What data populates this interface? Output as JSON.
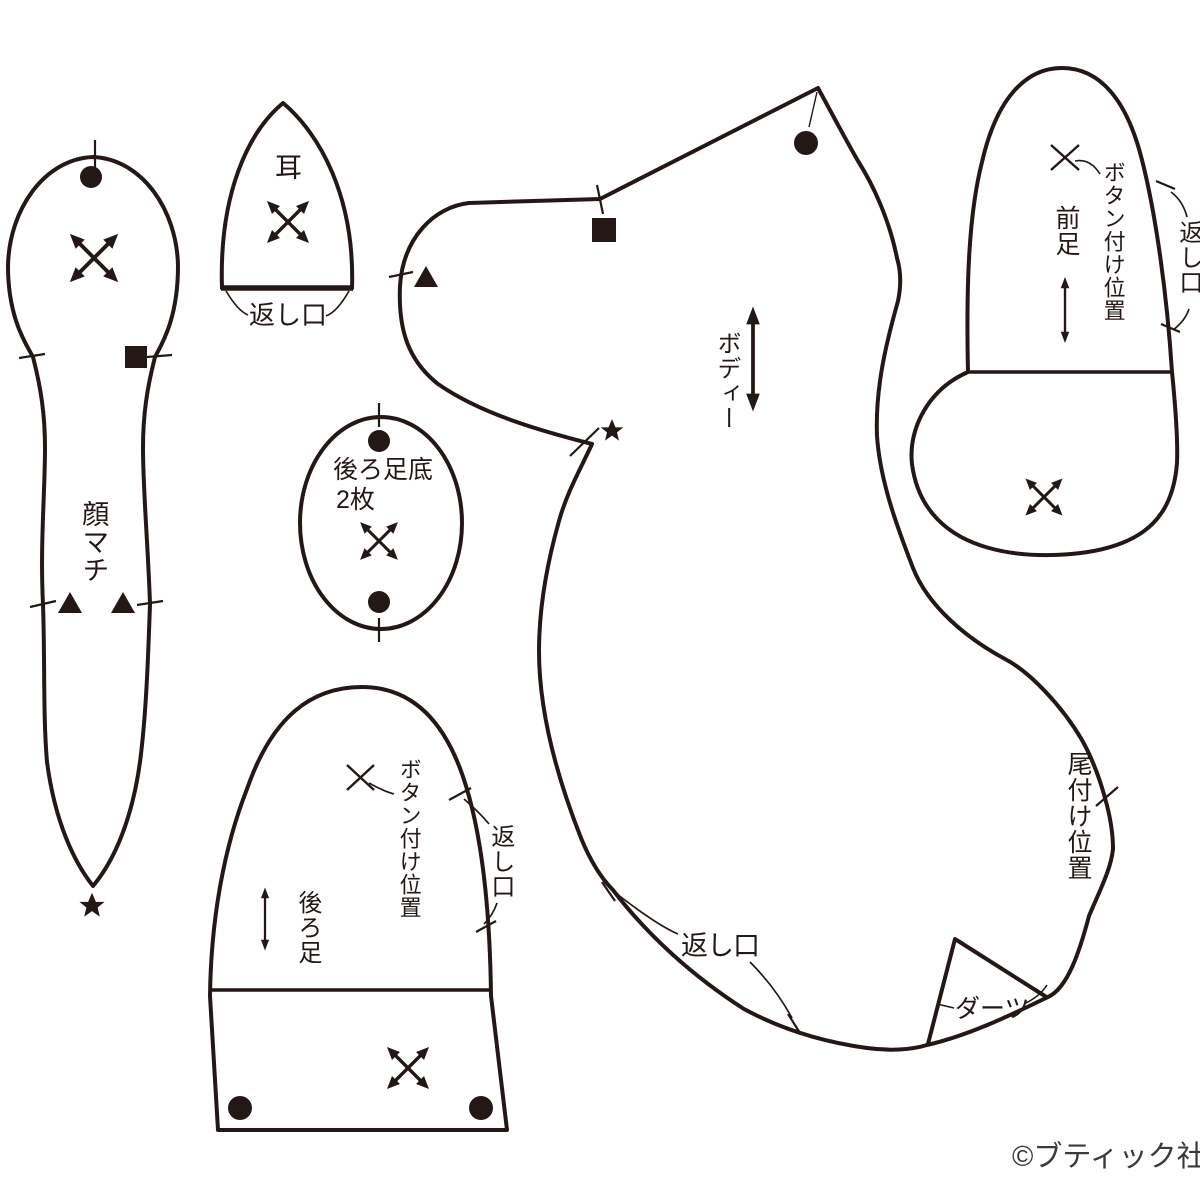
{
  "page": {
    "width": 1200,
    "height": 1200,
    "background": "#ffffff"
  },
  "colors": {
    "line": "#231815",
    "credit": "#3a3a3a"
  },
  "credit": "©ブティック社",
  "pieces": {
    "face_gusset": {
      "name_label": "顔マチ"
    },
    "ear": {
      "name_label": "耳",
      "opening_label": "返し口"
    },
    "rear_foot_sole": {
      "name_label": "後ろ足底",
      "quantity_label": "2枚"
    },
    "body": {
      "name_label": "ボディー",
      "opening_label": "返し口",
      "tail_position_label": "尾付け位置",
      "dart_label": "ダーツ"
    },
    "front_leg": {
      "name_label": "前足",
      "button_position_label": "ボタン付け位置",
      "opening_label": "返し口"
    },
    "back_leg": {
      "name_label": "後ろ足",
      "button_position_label": "ボタン付け位置",
      "opening_label": "返し口"
    }
  },
  "symbols": {
    "grainline": "four-way-cross-arrows",
    "straight_grain": "double-headed-arrow",
    "match_marks": [
      "dot",
      "square",
      "triangle",
      "star"
    ],
    "button_mark": "x-cross",
    "notch": "tick-line"
  }
}
